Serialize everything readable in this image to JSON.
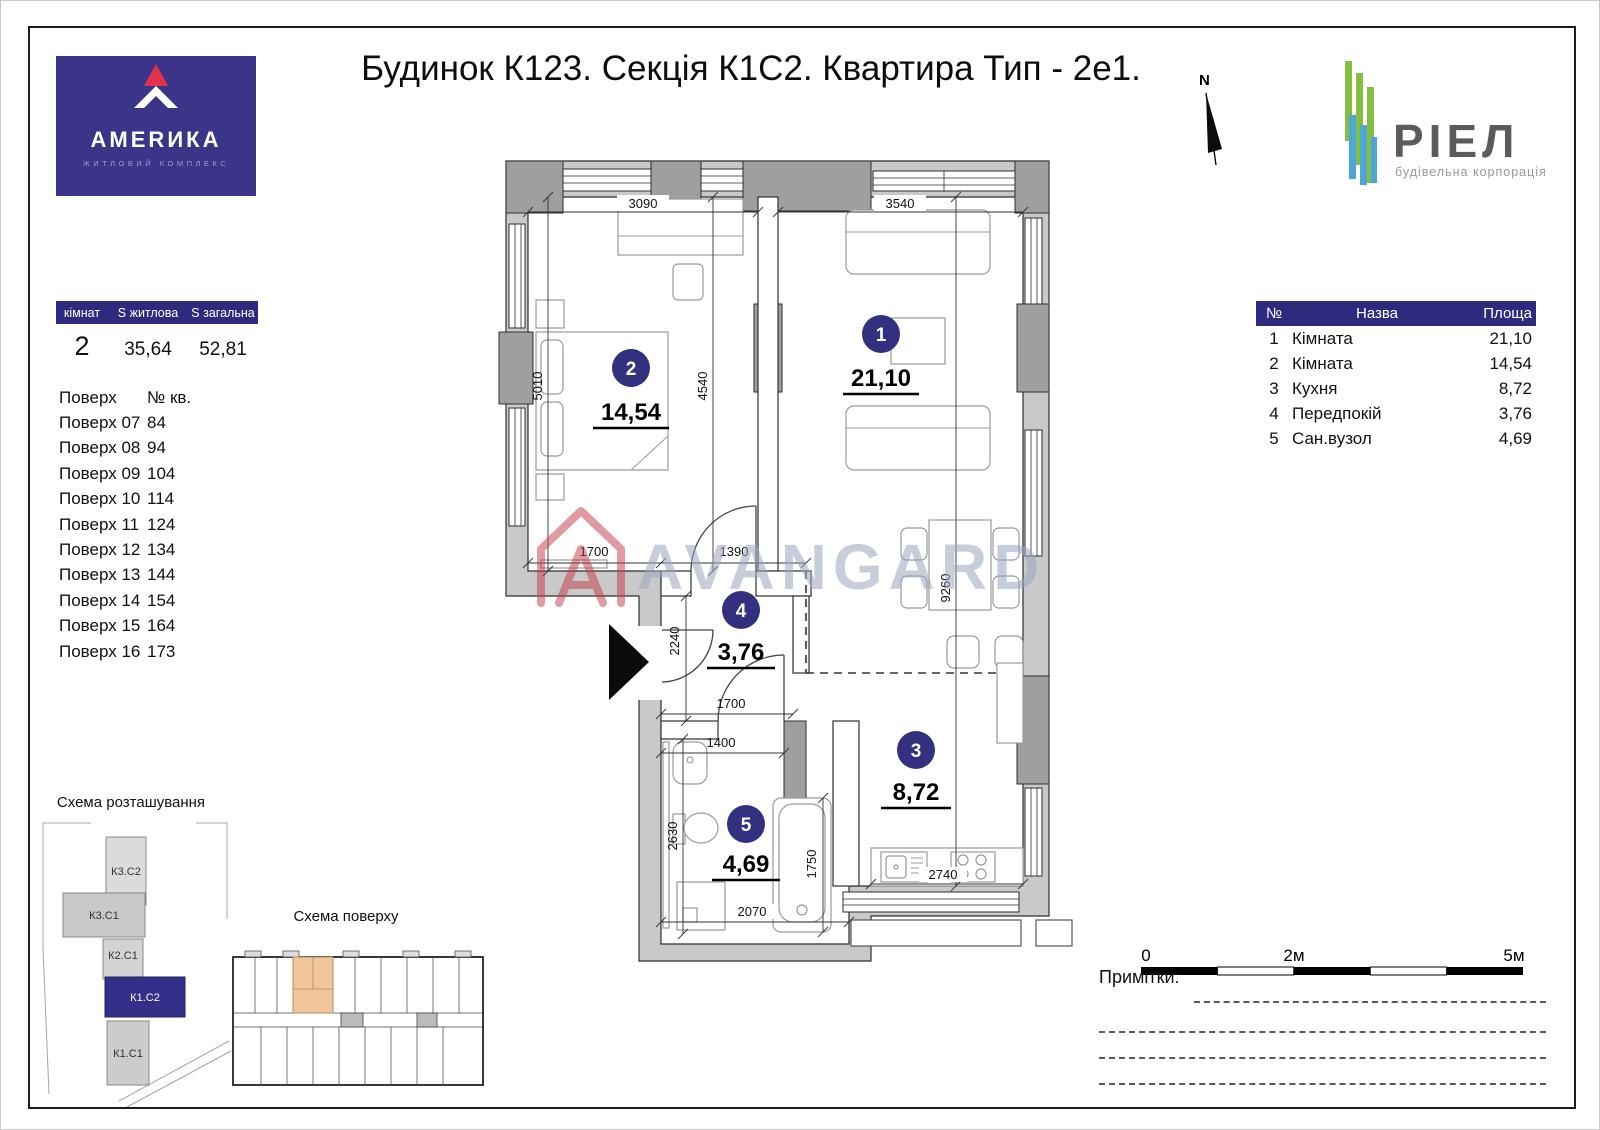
{
  "page": {
    "title": "Будинок К123. Секція К1С2. Квартира Тип - 2е1.",
    "north_label": "N"
  },
  "brand_amerika": {
    "name": "АМЕRИКА",
    "subtitle": "ЖИТЛОВИЙ КОМПЛЕКС"
  },
  "brand_riel": {
    "name": "РІЕЛ",
    "subtitle": "будівельна корпорація"
  },
  "summary": {
    "col_rooms": "кімнат",
    "col_living": "S житлова",
    "col_total": "S загальна",
    "rooms": "2",
    "living": "35,64",
    "total": "52,81"
  },
  "floors": {
    "col_floor": "Поверх",
    "col_apt": "№ кв.",
    "rows": [
      {
        "floor": "Поверх 07",
        "apt": "84"
      },
      {
        "floor": "Поверх 08",
        "apt": "94"
      },
      {
        "floor": "Поверх 09",
        "apt": "104"
      },
      {
        "floor": "Поверх 10",
        "apt": "114"
      },
      {
        "floor": "Поверх 11",
        "apt": "124"
      },
      {
        "floor": "Поверх 12",
        "apt": "134"
      },
      {
        "floor": "Поверх 13",
        "apt": "144"
      },
      {
        "floor": "Поверх 14",
        "apt": "154"
      },
      {
        "floor": "Поверх 15",
        "apt": "164"
      },
      {
        "floor": "Поверх 16",
        "apt": "173"
      }
    ]
  },
  "legend": {
    "col_num": "№",
    "col_name": "Назва",
    "col_area": "Площа",
    "rows": [
      {
        "num": "1",
        "name": "Кімната",
        "area": "21,10"
      },
      {
        "num": "2",
        "name": "Кімната",
        "area": "14,54"
      },
      {
        "num": "3",
        "name": "Кухня",
        "area": "8,72"
      },
      {
        "num": "4",
        "name": "Передпокій",
        "area": "3,76"
      },
      {
        "num": "5",
        "name": "Сан.вузол",
        "area": "4,69"
      }
    ]
  },
  "plan": {
    "markers": [
      {
        "num": "1",
        "area": "21,10"
      },
      {
        "num": "2",
        "area": "14,54"
      },
      {
        "num": "3",
        "area": "8,72"
      },
      {
        "num": "4",
        "area": "3,76"
      },
      {
        "num": "5",
        "area": "4,69"
      }
    ],
    "dims": {
      "top_left": "3090",
      "top_right": "3540",
      "left": "5010",
      "mid": "4540",
      "right": "9260",
      "room2_bottom": "1700",
      "hall_top": "1390",
      "hall_left": "2240",
      "hall_bottom": "1700",
      "bath_top": "1400",
      "bath_left": "2630",
      "tub": "1750",
      "bath_bottom": "2070",
      "kitchen": "2740"
    }
  },
  "site_plan": {
    "title": "Схема розташування",
    "buildings": [
      {
        "label": "К3.С2"
      },
      {
        "label": "К3.С1"
      },
      {
        "label": "К2.С1"
      },
      {
        "label": "К1.С2"
      },
      {
        "label": "К1.С1"
      }
    ]
  },
  "floor_scheme": {
    "title": "Схема поверху"
  },
  "scale_bar": {
    "start": "0",
    "mid": "2м",
    "end": "5м"
  },
  "notes_label": "Примітки:",
  "watermark": "AVANGARD",
  "colors": {
    "accent": "#32307f",
    "unit_highlight": "#f1c59c",
    "riel_green": "#86bf3f",
    "riel_blue": "#4da6d8",
    "logo_red": "#e23249"
  }
}
